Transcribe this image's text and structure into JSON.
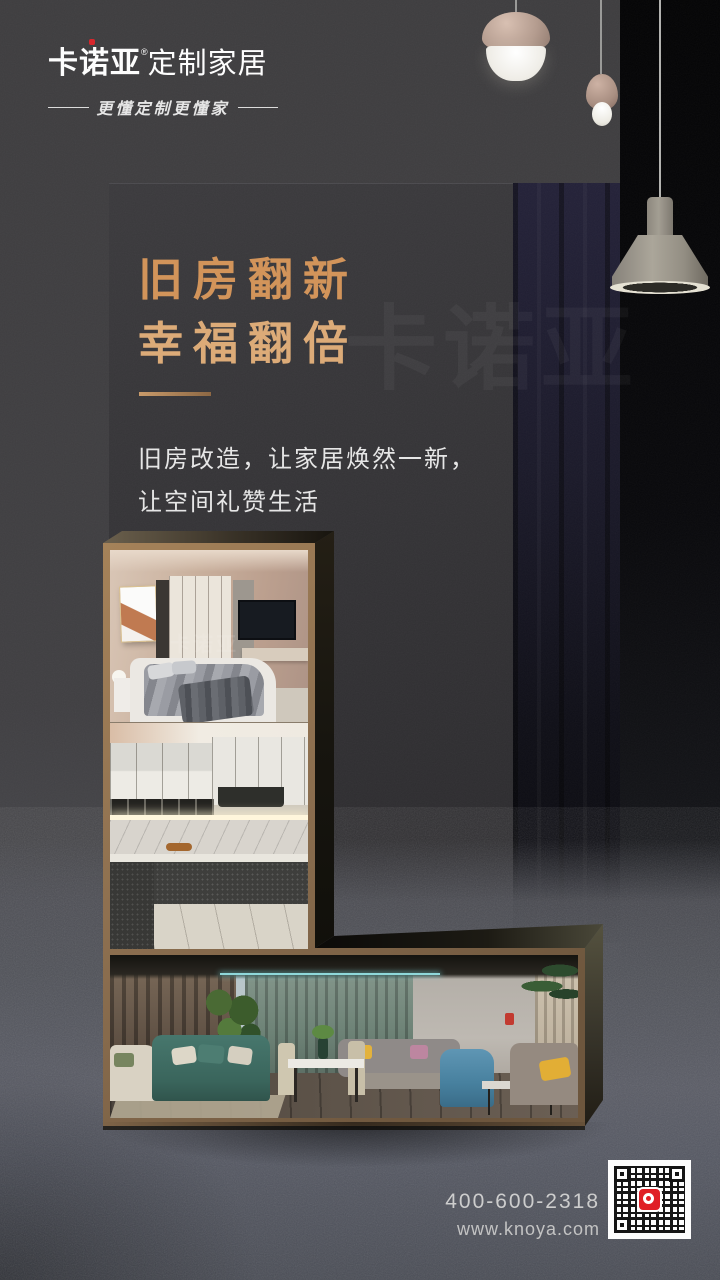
{
  "brand": {
    "name": "卡诺亚",
    "registered": "®",
    "suffix": "定制家居",
    "slogan": "更懂定制更懂家"
  },
  "headline": {
    "line1": "旧房翻新",
    "line2": "幸福翻倍"
  },
  "body_copy": {
    "line1": "旧房改造，让家居焕然一新，",
    "line2": "让空间礼赞生活"
  },
  "photos": {
    "watermark": "卡诺亚",
    "items": [
      "bedroom",
      "kitchen",
      "living-room"
    ]
  },
  "footer": {
    "phone": "400-600-2318",
    "website": "www.knoya.com"
  },
  "colors": {
    "accent_gold": "#d2945a",
    "brand_red": "#d8262c",
    "qr_logo_red": "#e01f26"
  }
}
